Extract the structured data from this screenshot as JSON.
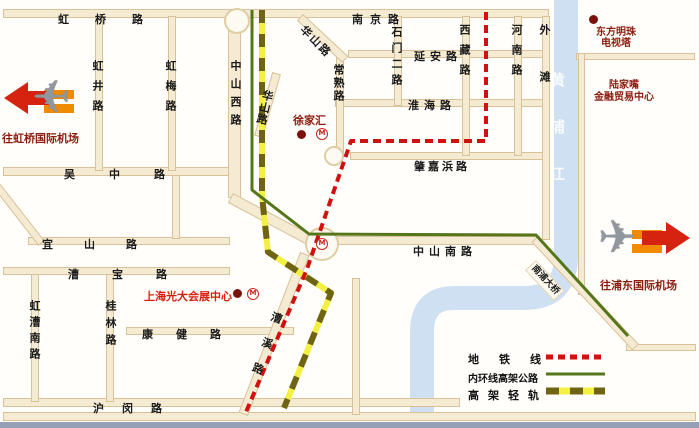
{
  "title": "上海交通示意图",
  "colors": {
    "metro_line": "#cf1110",
    "ring_road": "#55761a",
    "rail_base": "#f4f043",
    "rail_dash": "#6e6414",
    "river": "#cfe0f3",
    "road_fill": "#f5ead2",
    "road_border": "#d9c29a",
    "poi_dark_red": "#8b1d10",
    "poi_bright_red": "#d6200f"
  },
  "roads": {
    "h": [
      {
        "label": "虹桥路"
      },
      {
        "label": "南京路"
      },
      {
        "label": "延安路"
      },
      {
        "label": "淮海路"
      },
      {
        "label": "肇嘉浜路"
      },
      {
        "label": "吴中路"
      },
      {
        "label": "宜山路"
      },
      {
        "label": "漕宝路"
      },
      {
        "label": "中山南路"
      },
      {
        "label": "康健路"
      },
      {
        "label": "沪闵路"
      }
    ],
    "v": [
      {
        "label": "虹井路"
      },
      {
        "label": "虹梅路"
      },
      {
        "label": "中山西路"
      },
      {
        "label": "常熟路"
      },
      {
        "label": "石门二路"
      },
      {
        "label": "西藏路"
      },
      {
        "label": "河南路"
      },
      {
        "label": "外滩"
      },
      {
        "label": "桂林路"
      },
      {
        "label": "虹漕南路"
      }
    ],
    "d": [
      {
        "label": "华山路"
      },
      {
        "label": "华山路"
      },
      {
        "label": "漕溪路"
      },
      {
        "label": "南浦大桥"
      }
    ]
  },
  "river": {
    "label": "黄浦江"
  },
  "pois": {
    "hongqiao_airport": {
      "label": "往虹桥国际机场"
    },
    "pudong_airport": {
      "label": "往浦东国际机场"
    },
    "pearl_tower": {
      "line1": "东方明珠",
      "line2": "电视塔"
    },
    "lujiazui": {
      "line1": "陆家嘴",
      "line2": "金融贸易中心"
    },
    "xujiahui": {
      "label": "徐家汇"
    },
    "everbright": {
      "label": "上海光大会展中心"
    }
  },
  "legend": {
    "metro": {
      "label": "地铁线"
    },
    "ring": {
      "label": "内环线高架公路"
    },
    "rail": {
      "label": "高架轻轨"
    }
  },
  "stations": {
    "icon_letter": "M"
  }
}
